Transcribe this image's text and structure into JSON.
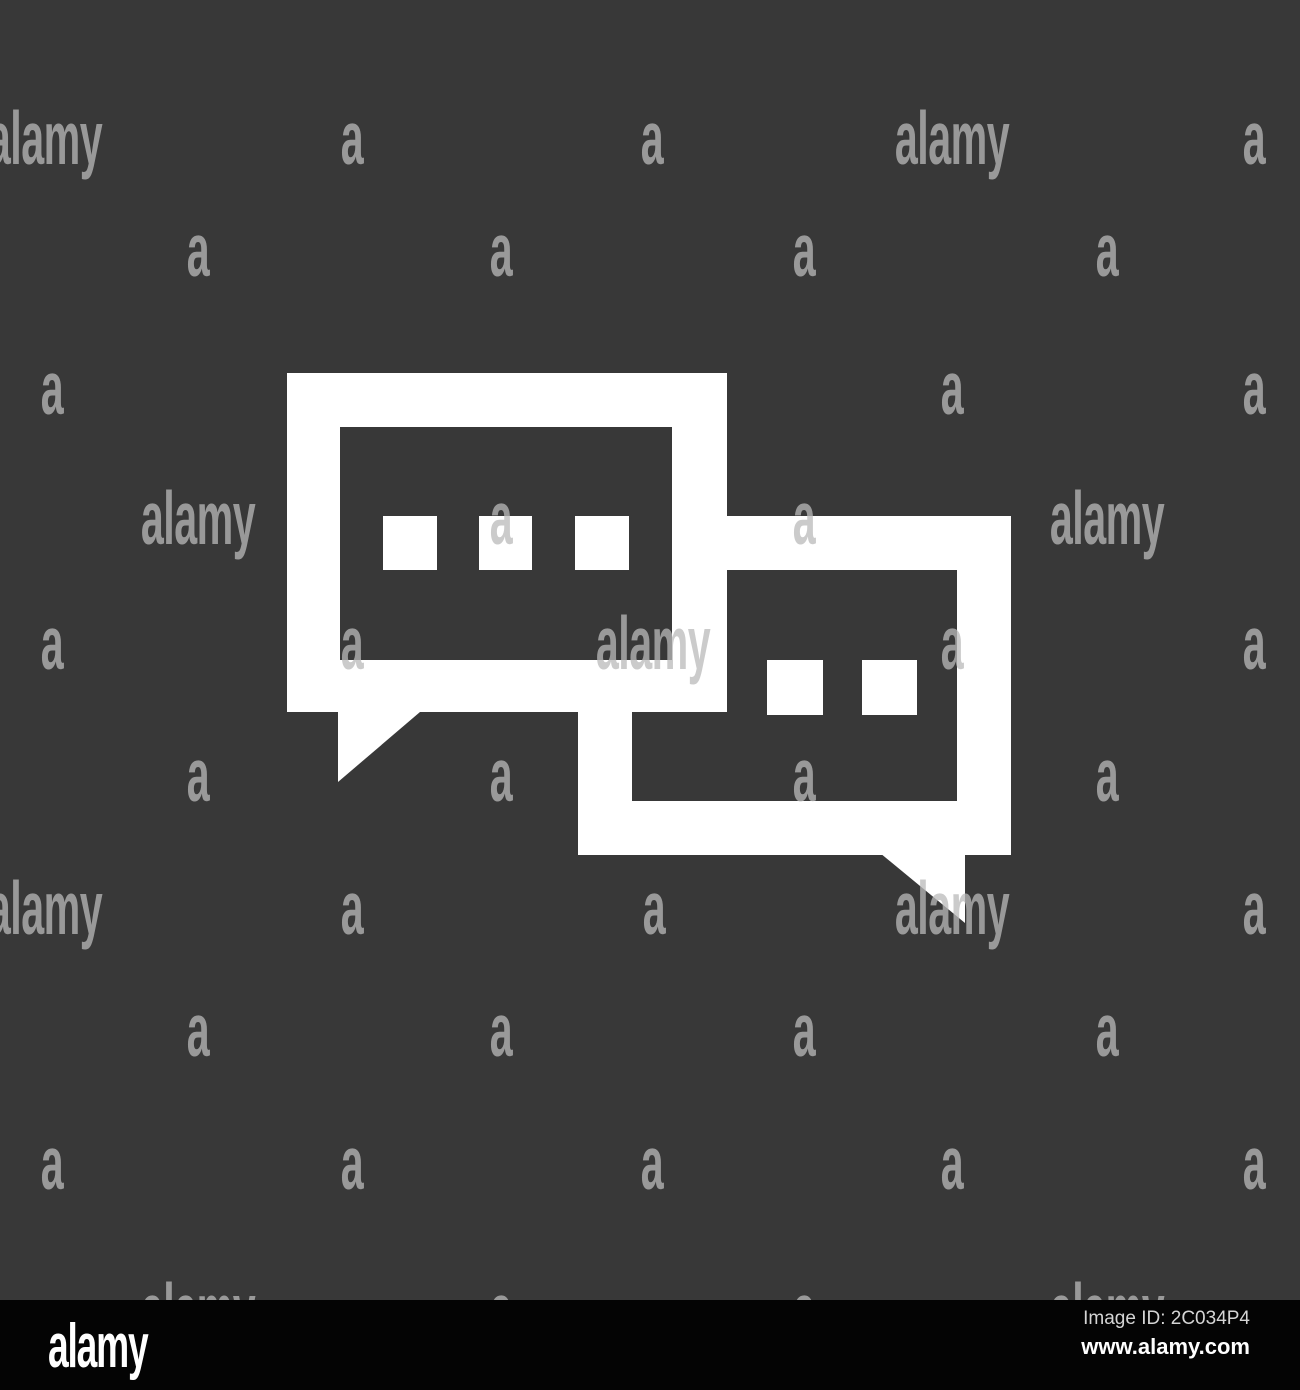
{
  "page": {
    "width": 1300,
    "height": 1390,
    "background_color": "#383838"
  },
  "icon": {
    "name": "chat-speech-bubbles-glyph",
    "description": "two overlapping rectangular speech bubbles with typing dots",
    "glyph_color": "#ffffff",
    "interior_color": "#383838",
    "left_bubble_dots": 3,
    "right_bubble_dots": 2
  },
  "watermark": {
    "word": "alamy",
    "letter": "a",
    "color": "rgba(185,185,185,0.75)",
    "rows": [
      {
        "y": 140,
        "items": [
          {
            "x": 45,
            "t": "word"
          },
          {
            "x": 352,
            "t": "a"
          },
          {
            "x": 652,
            "t": "a"
          },
          {
            "x": 952,
            "t": "word"
          },
          {
            "x": 1254,
            "t": "a"
          }
        ]
      },
      {
        "y": 252,
        "items": [
          {
            "x": 198,
            "t": "a"
          },
          {
            "x": 501,
            "t": "a"
          },
          {
            "x": 804,
            "t": "a"
          },
          {
            "x": 1107,
            "t": "a"
          }
        ]
      },
      {
        "y": 390,
        "items": [
          {
            "x": 52,
            "t": "a"
          },
          {
            "x": 952,
            "t": "a"
          },
          {
            "x": 1254,
            "t": "a"
          }
        ]
      },
      {
        "y": 520,
        "items": [
          {
            "x": 198,
            "t": "word"
          },
          {
            "x": 501,
            "t": "a"
          },
          {
            "x": 804,
            "t": "a"
          },
          {
            "x": 1107,
            "t": "word"
          }
        ]
      },
      {
        "y": 645,
        "items": [
          {
            "x": 52,
            "t": "a"
          },
          {
            "x": 352,
            "t": "a"
          },
          {
            "x": 653,
            "t": "word"
          },
          {
            "x": 952,
            "t": "a"
          },
          {
            "x": 1254,
            "t": "a"
          }
        ]
      },
      {
        "y": 777,
        "items": [
          {
            "x": 198,
            "t": "a"
          },
          {
            "x": 501,
            "t": "a"
          },
          {
            "x": 804,
            "t": "a"
          },
          {
            "x": 1107,
            "t": "a"
          }
        ]
      },
      {
        "y": 910,
        "items": [
          {
            "x": 45,
            "t": "word"
          },
          {
            "x": 352,
            "t": "a"
          },
          {
            "x": 654,
            "t": "a"
          },
          {
            "x": 952,
            "t": "word"
          },
          {
            "x": 1254,
            "t": "a"
          }
        ]
      },
      {
        "y": 1032,
        "items": [
          {
            "x": 198,
            "t": "a"
          },
          {
            "x": 501,
            "t": "a"
          },
          {
            "x": 804,
            "t": "a"
          },
          {
            "x": 1107,
            "t": "a"
          }
        ]
      },
      {
        "y": 1165,
        "items": [
          {
            "x": 52,
            "t": "a"
          },
          {
            "x": 352,
            "t": "a"
          },
          {
            "x": 652,
            "t": "a"
          },
          {
            "x": 952,
            "t": "a"
          },
          {
            "x": 1254,
            "t": "a"
          }
        ]
      },
      {
        "y": 1312,
        "items": [
          {
            "x": 198,
            "t": "word"
          },
          {
            "x": 501,
            "t": "a"
          },
          {
            "x": 804,
            "t": "a"
          },
          {
            "x": 1107,
            "t": "word"
          }
        ]
      }
    ]
  },
  "footer": {
    "background_color": "#040404",
    "logo_text": "alamy",
    "image_id_text": "Image ID: 2C034P4",
    "url_text": "www.alamy.com"
  }
}
